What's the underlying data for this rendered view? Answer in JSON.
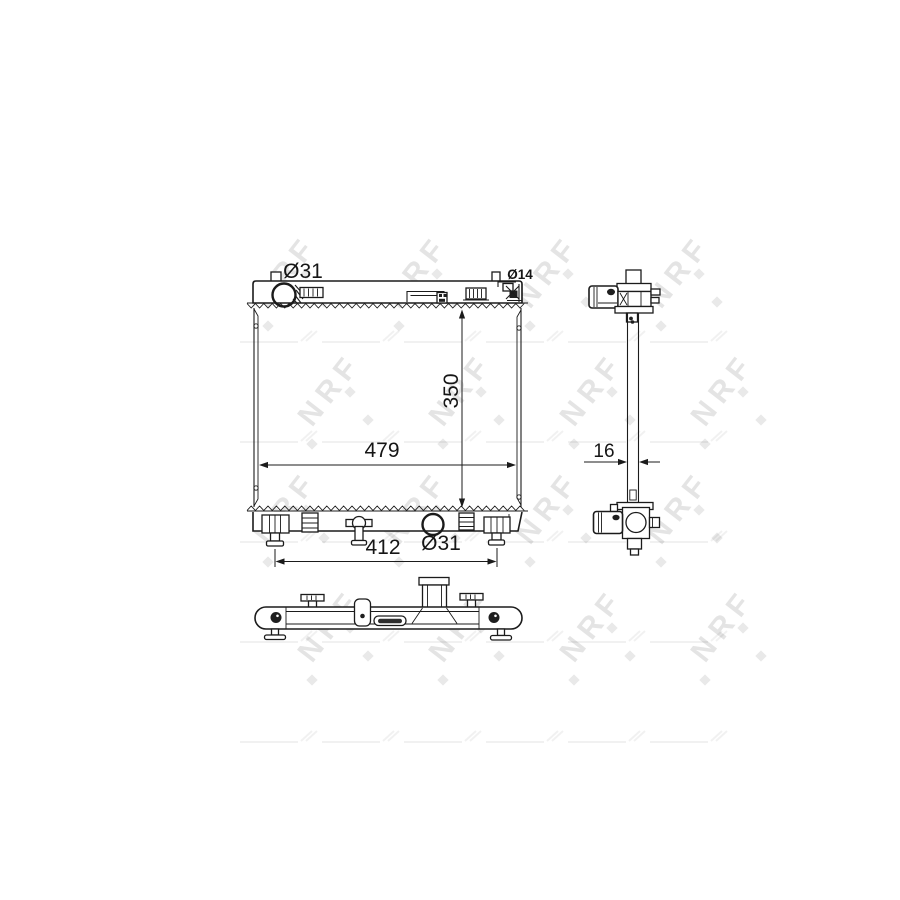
{
  "drawing": {
    "type": "radiator-technical-drawing",
    "colors": {
      "line": "#1b1b1b",
      "background": "#ffffff",
      "watermark": "#e4e4e4"
    },
    "views": {
      "front": {
        "labels": {
          "inlet_diameter": "Ø31",
          "filler_diameter": "Ø14",
          "core_height": "350",
          "core_width": "479",
          "mount_pin_spacing": "412",
          "outlet_diameter": "Ø31"
        }
      },
      "side": {
        "labels": {
          "core_thickness": "16"
        }
      }
    }
  },
  "watermark": {
    "text": "NRF"
  }
}
